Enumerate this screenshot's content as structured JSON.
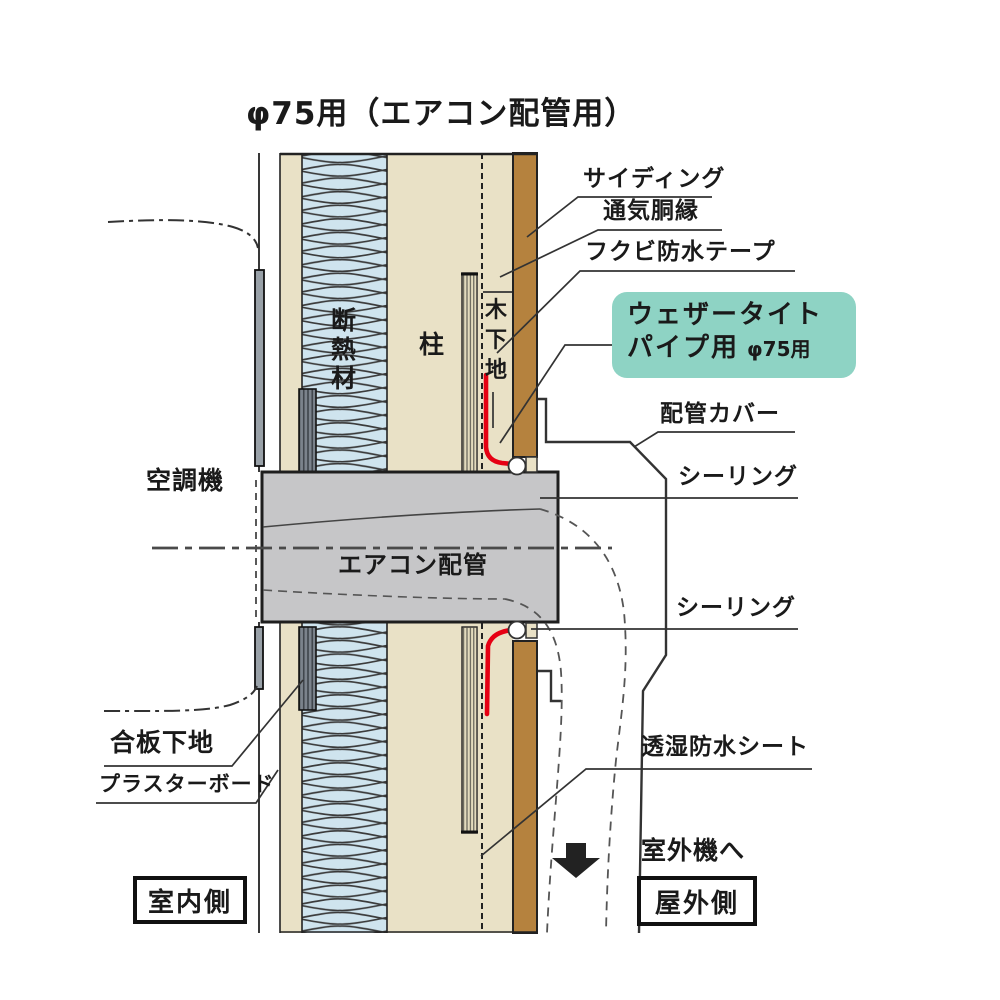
{
  "title": "φ75用（エアコン配管用）",
  "labels": {
    "siding": "サイディング",
    "furring": "通気胴縁",
    "waterproof_tape": "フクビ防水テープ",
    "pipe_cover": "配管カバー",
    "sealing_top": "シーリング",
    "sealing_bottom": "シーリング",
    "pipe": "エアコン配管",
    "ac_unit": "空調機",
    "plywood_base": "合板下地",
    "plasterboard": "プラスターボード",
    "housewrap": "透湿防水シート",
    "to_outdoor_unit": "室外機へ",
    "indoor_side": "室内側",
    "outdoor_side": "屋外側",
    "column": "柱"
  },
  "product_badge": {
    "line1": "ウェザータイト",
    "line2": "パイプ用",
    "size": "φ75用",
    "bg_color": "#8ed3c4"
  },
  "vertical_labels": {
    "insulation": [
      "断",
      "熱",
      "材"
    ],
    "wood_base": [
      "木",
      "下",
      "地"
    ]
  },
  "colors": {
    "wall_beige": "#e9e1c6",
    "insulation_blue": "#cfe4ee",
    "siding_brown": "#b5823e",
    "pipe_gray": "#c6c6c8",
    "tape_red": "#e60013",
    "badge_teal": "#8ed3c4"
  }
}
